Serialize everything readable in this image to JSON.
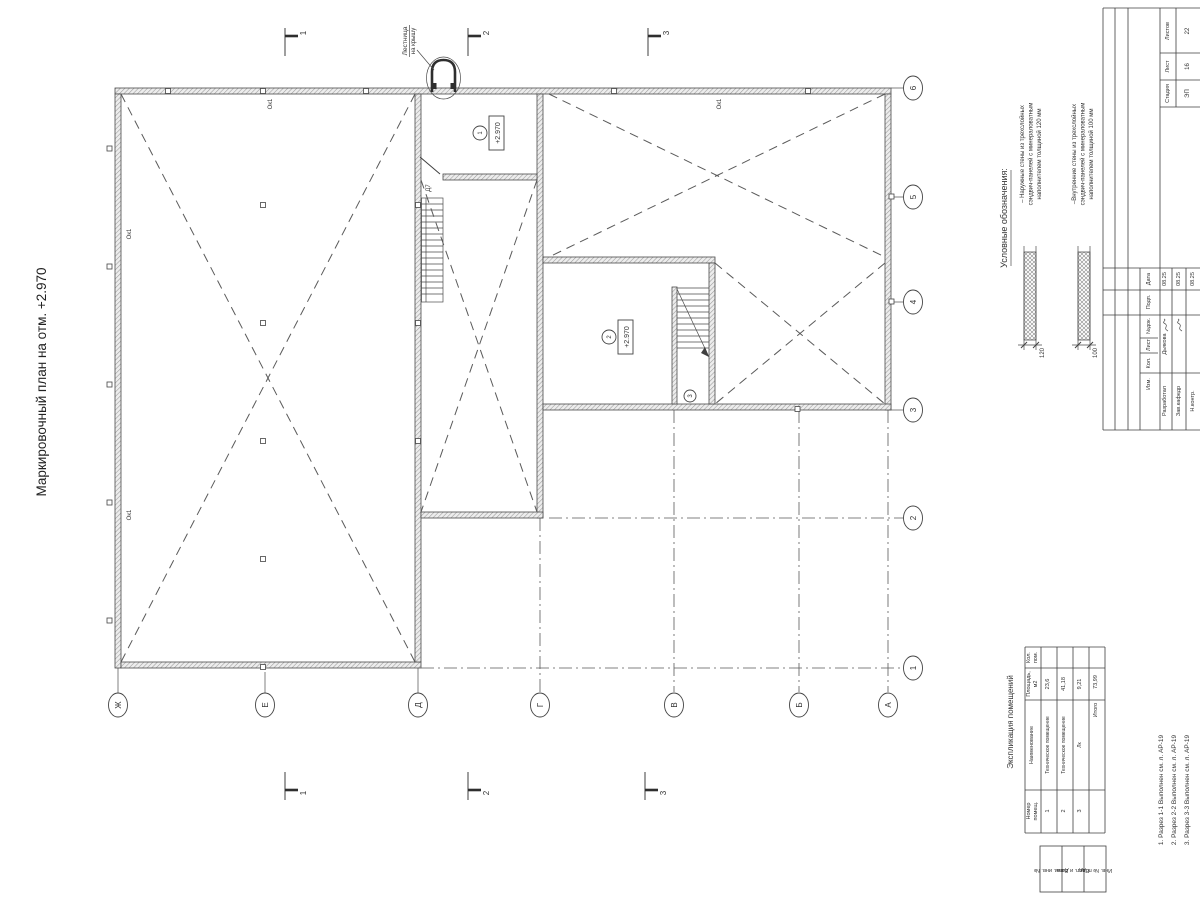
{
  "drawing_title": "Маркировочный план на отм. +2.970",
  "plan": {
    "axis_numbers": [
      "6",
      "5",
      "4",
      "3",
      "2",
      "1"
    ],
    "axis_letters": [
      "Ж",
      "Е",
      "Д",
      "Г",
      "В",
      "Б",
      "А"
    ],
    "section_marks_top": [
      "1",
      "2",
      "3"
    ],
    "section_marks_bottom": [
      "1",
      "2",
      "3"
    ],
    "window_labels": [
      "Ок1",
      "Ок1",
      "Ок1",
      "Ок1"
    ],
    "door_label": "Д7",
    "roof_ladder_label": [
      "Лестница",
      "на крышу"
    ],
    "rooms": [
      {
        "number": "1",
        "elevation": "+2.970"
      },
      {
        "number": "2",
        "elevation": "+2.970"
      },
      {
        "number": "3"
      }
    ]
  },
  "legend": {
    "title": "Условные обозначения:",
    "items": [
      {
        "lines": [
          "– Наружные стены из трехслойных",
          "сэндвич-панелей с минераловатным",
          "наполнителем толщиной 120 мм"
        ],
        "dim": "120"
      },
      {
        "lines": [
          "–Внутренние стены из трехслойных",
          "сэндвич-панелей с минераловатным",
          "наполнителем толщиной 100 мм"
        ],
        "dim": "100"
      }
    ]
  },
  "explication": {
    "title": "Экспликация помещений",
    "headers": {
      "number": [
        "Номер",
        "помещ."
      ],
      "name": "Наименование",
      "area": [
        "Площадь,",
        "м2"
      ],
      "count": [
        "Кол.",
        "пом."
      ]
    },
    "rows": [
      {
        "number": "1",
        "name": "Техническое помещение",
        "area": "23,6"
      },
      {
        "number": "2",
        "name": "Техническое помещение",
        "area": "41,18"
      },
      {
        "number": "3",
        "name": "Лк",
        "area": "9,21"
      }
    ],
    "total_label": "Итого",
    "total_area": "73,99"
  },
  "notes": [
    "1. Разрез 1-1 Выполнен см. л. АР-19",
    "2. Разрез 2-2 Выполнен см. л. АР-19",
    "3. Разрез 3-3 Выполнен см. л. АР-19"
  ],
  "stamp": {
    "stage_label": "Стадия",
    "stage": "ЭП",
    "sheet_label": "Лист",
    "sheet": "16",
    "sheets_label": "Листов",
    "sheets": "22",
    "rev_headers": [
      "Дата",
      "Подп.",
      "№док.",
      "Лист",
      "Кол.",
      "Изм."
    ],
    "rows": [
      {
        "role": "Разработал",
        "name": "Дьякова",
        "date": "08.25"
      },
      {
        "role": "Зав.кафедр",
        "name": "",
        "date": "08.25"
      },
      {
        "role": "Н.контр.",
        "name": "",
        "date": "08.25"
      }
    ]
  },
  "side_columns": [
    "Взам. инв. №",
    "Подп. и дата",
    "Инв. № подл."
  ]
}
